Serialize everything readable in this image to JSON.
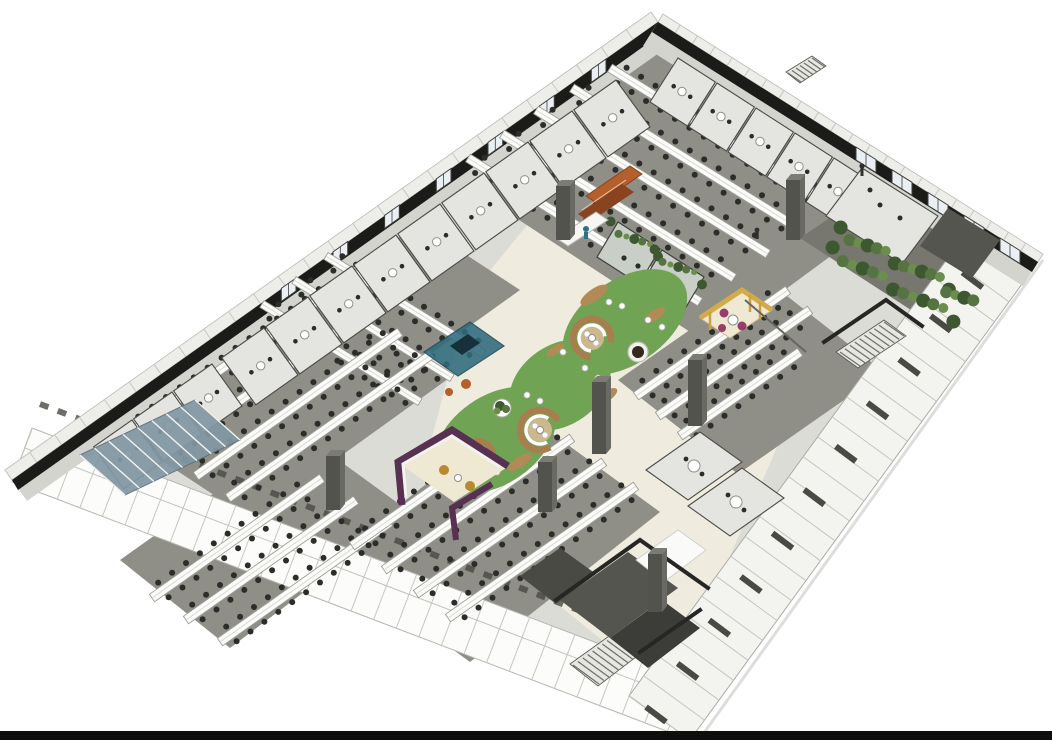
{
  "scene": {
    "kind": "isometric-architectural-rendering",
    "subject": "open-plan office floor cutaway with central lawn lounge",
    "areas": [
      "perimeter-meeting-rooms",
      "open-desk-zones",
      "central-lawn-lounge",
      "circular-seating-pods",
      "plant-wall-lounge",
      "cafe-shelf-counter",
      "yellow-phone-booth",
      "purple-sofa-booth",
      "stairwells",
      "glass-meeting-pods"
    ]
  },
  "palette": {
    "bg": "#ffffff",
    "bottom_bar": "#0e0e0c",
    "cut_wall": "#1b1b19",
    "wall_face": "#d4d4cf",
    "wall_face_light": "#e6e6e2",
    "eave": "#ededea",
    "floor": "#dcdcd7",
    "atrium": "#efecdf",
    "carpet": "#8f8f88",
    "carpet_dark": "#77776f",
    "desk_white": "#fbfbf9",
    "chair_black": "#2c2c2a",
    "room_fill": "#e4e4e0",
    "lawn_green": "#71a355",
    "bench_brown": "#a97e4f",
    "mulch_brown": "#b18a55",
    "seat_tan": "#cdb88e",
    "hedge_dark": "#3d5830",
    "hedge_mid": "#567441",
    "hedge_light": "#6b8d4e",
    "glass_blue": "#8298a5",
    "glass_teal": "#2f6b7d",
    "glass_navy": "#16303c",
    "shelf_orange": "#b45f2c",
    "shelf_orange_dark": "#8a431f",
    "booth_yellow": "#d2ab4a",
    "booth_cream": "#efe8d2",
    "chair_magenta": "#963d68",
    "booth_purple": "#583052",
    "chair_gold": "#b8892e",
    "pillar": "#53534e",
    "pillar_side": "#6a6a64",
    "pillar_top": "#7c7c74",
    "stair_fill": "#e6e6e2",
    "dark_room": "#55554f",
    "darker_room": "#3c3c38",
    "facade_sw": "#fcfcfb",
    "facade_se": "#f3f3f0",
    "window_glass": "#e9eff3",
    "person_blue": "#2e7086"
  }
}
